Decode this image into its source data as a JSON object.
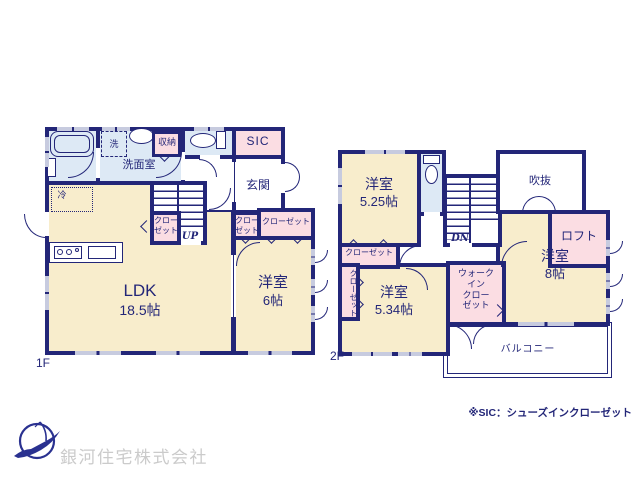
{
  "colors": {
    "wall": "#232678",
    "room_cream": "#f8edcc",
    "room_blue": "#dde9f5",
    "room_pink": "#fbdde3",
    "window": "#c7cbdf",
    "company_text": "#cbcbcb"
  },
  "floor1": {
    "label": "1F",
    "ldk": {
      "name": "LDK",
      "size": "18.5帖"
    },
    "bedroom": {
      "name": "洋室",
      "size": "6帖"
    },
    "washroom": "洗面室",
    "laundry": "洗",
    "storage": "収納",
    "sic": "SIC",
    "entrance": "玄関",
    "fridge": "冷",
    "closet_under_stairs": "クローゼット",
    "closet_small": "クローゼット",
    "closet_wide": "クローゼット",
    "stairs": "UP"
  },
  "floor2": {
    "label": "2F",
    "bedroom_525": {
      "name": "洋室",
      "size": "5.25帖"
    },
    "bedroom_534": {
      "name": "洋室",
      "size": "5.34帖"
    },
    "bedroom_8": {
      "name": "洋室",
      "size": "8帖"
    },
    "void": "吹抜",
    "loft": "ロフト",
    "balcony": "バルコニー",
    "closet": "クローゼット",
    "closet_side": "クローゼット",
    "walk_in_closet": [
      "ウォーク",
      "イン",
      "クロー",
      "ゼット"
    ],
    "stairs": "DN"
  },
  "footer": {
    "note": "※SIC：シューズインクローゼット",
    "company": "銀河住宅株式会社"
  }
}
